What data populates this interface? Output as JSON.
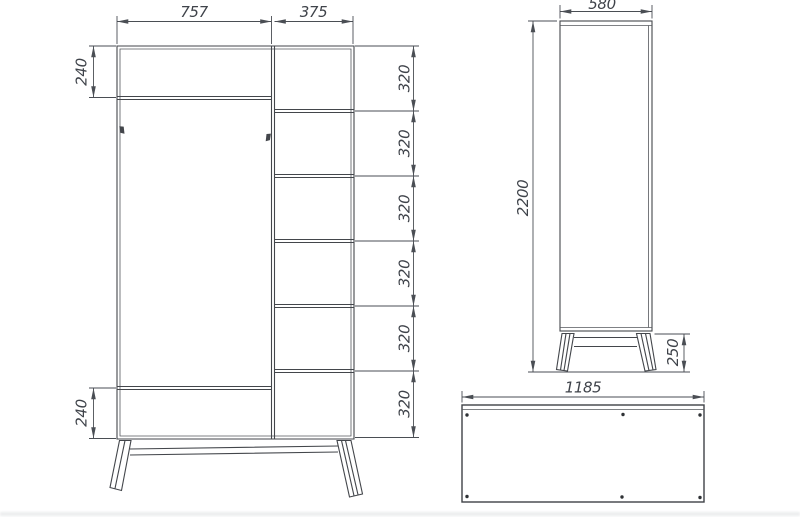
{
  "drawing": {
    "kind": "furniture-technical-drawing",
    "subject": "wardrobe-orthographic-views",
    "colors": {
      "outline": "#43464b",
      "dimension": "#4a4e54",
      "text": "#3f434a",
      "background": "#ffffff"
    },
    "front_view": {
      "door_width": "757",
      "shelf_column_width": "375",
      "top_panel_height": "240",
      "bottom_panel_height": "240",
      "shelf_segments": [
        "320",
        "320",
        "320",
        "320",
        "320",
        "320"
      ]
    },
    "side_view": {
      "depth": "580",
      "total_height": "2200",
      "leg_height": "250"
    },
    "top_view": {
      "width": "1185"
    }
  }
}
